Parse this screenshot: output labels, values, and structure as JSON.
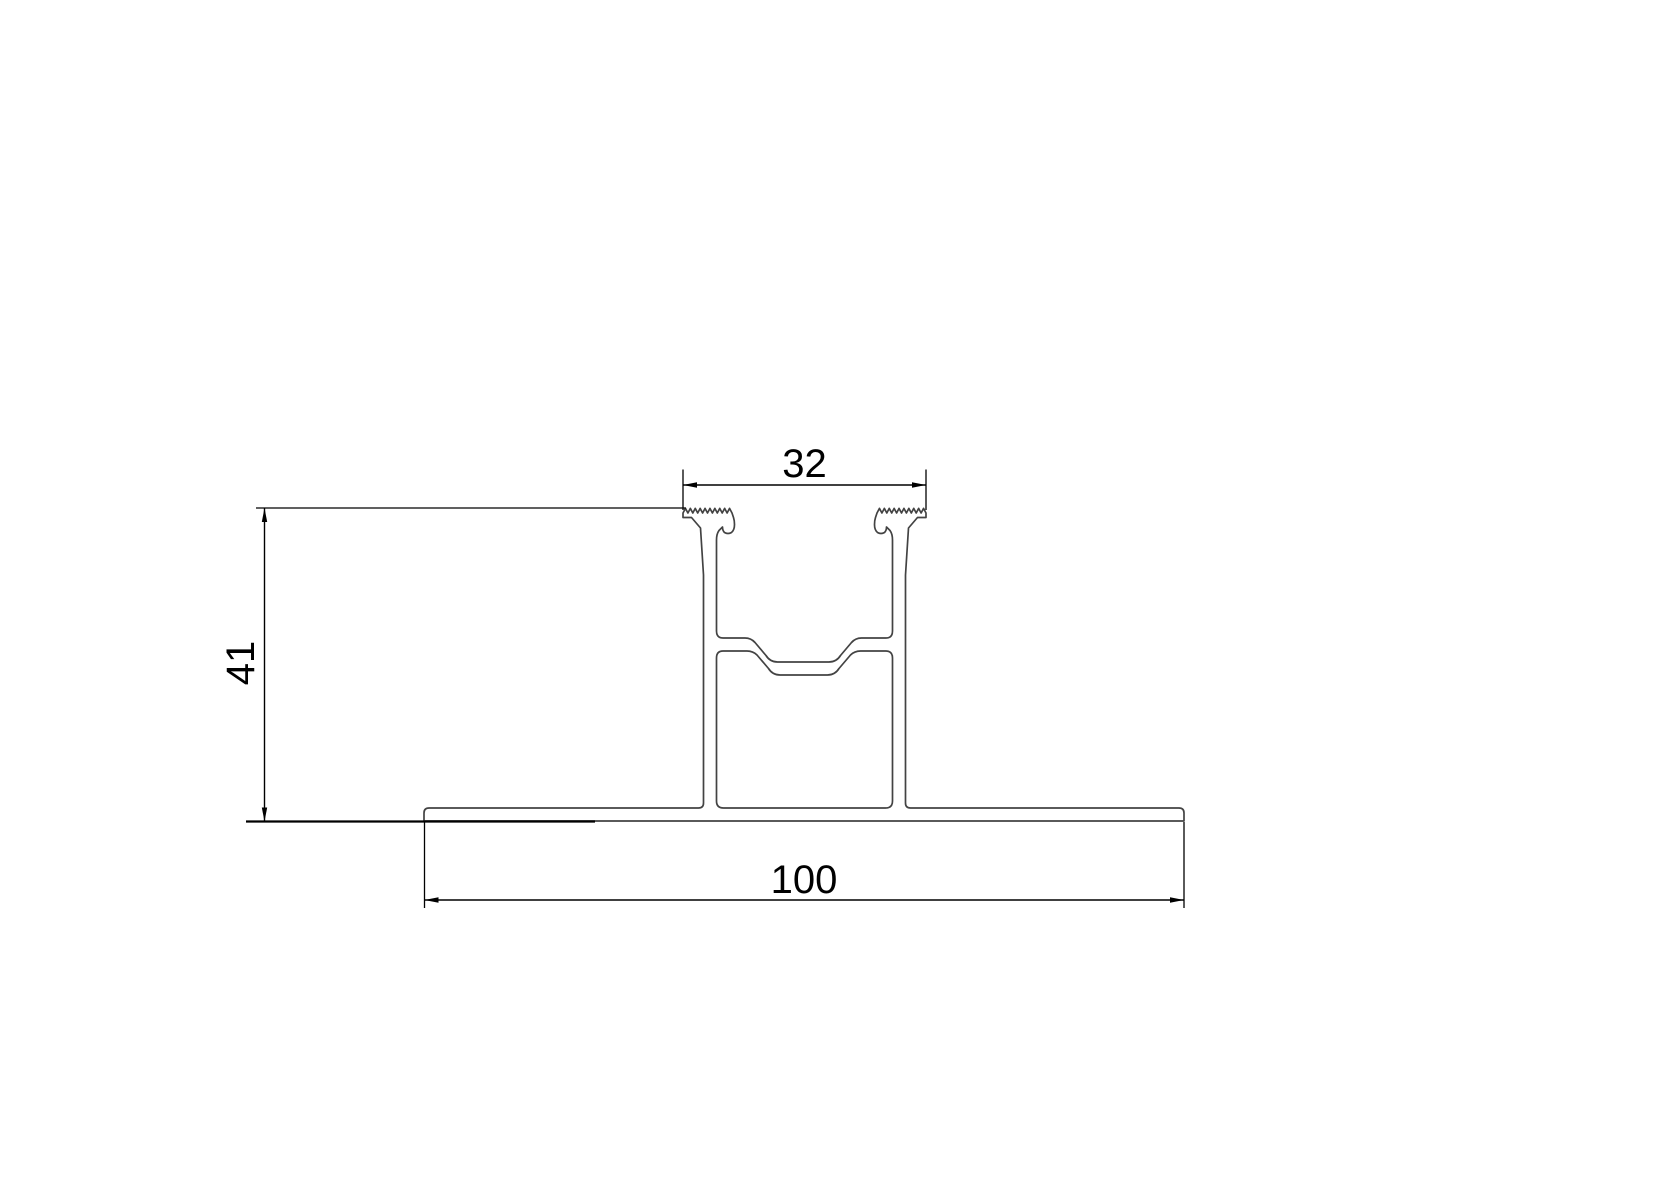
{
  "drawing": {
    "kind": "extrusion-profile-cross-section",
    "dimensions": {
      "top_width": "32",
      "overall_height": "41",
      "base_width": "100"
    },
    "colors": {
      "background": "#ffffff",
      "profile_line": "#434343",
      "dimension_line": "#000000",
      "label_text": "#000000"
    }
  }
}
